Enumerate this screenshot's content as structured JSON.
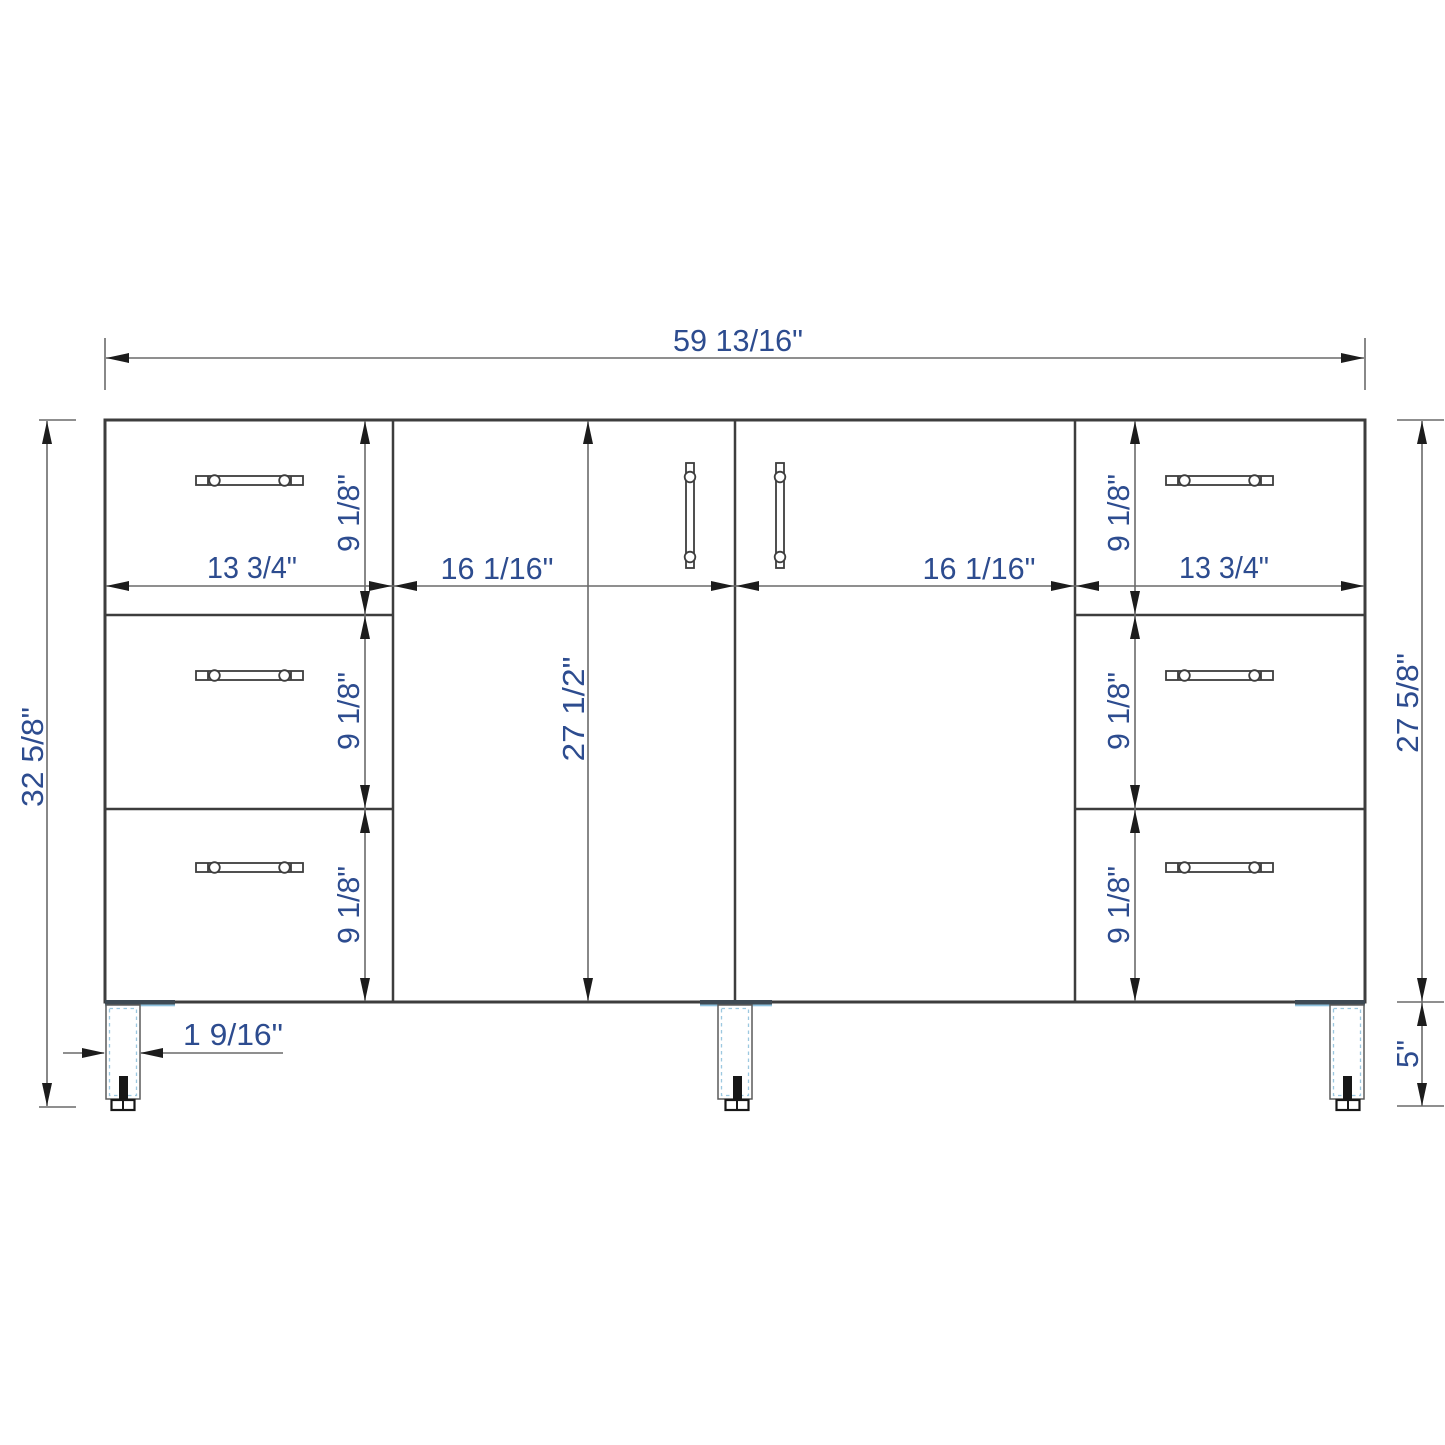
{
  "drawing": {
    "type": "cabinet-dimension-diagram",
    "subject": "bathroom vanity cabinet front elevation with dimension callouts",
    "units": "inches",
    "labels": {
      "overall_width": "59 13/16\"",
      "overall_height": "32 5/8\"",
      "cabinet_body_height": "27 5/8\"",
      "door_height": "27 1/2\"",
      "door_width": "16 1/16\"",
      "drawer_width": "13 3/4\"",
      "drawer_height": "9 1/8\"",
      "leg_width": "1 9/16\"",
      "leg_height": "5\""
    },
    "colors": {
      "background": "#ffffff",
      "cabinet_line": "#3d3d3d",
      "dimension_line": "#6a6a6a",
      "arrow": "#1c1c1c",
      "label_text": "#2d4c8f",
      "leg_dashed_edge": "#9cc8e0",
      "leg_plate": "#3e4a54",
      "bolt": "#171717"
    }
  }
}
